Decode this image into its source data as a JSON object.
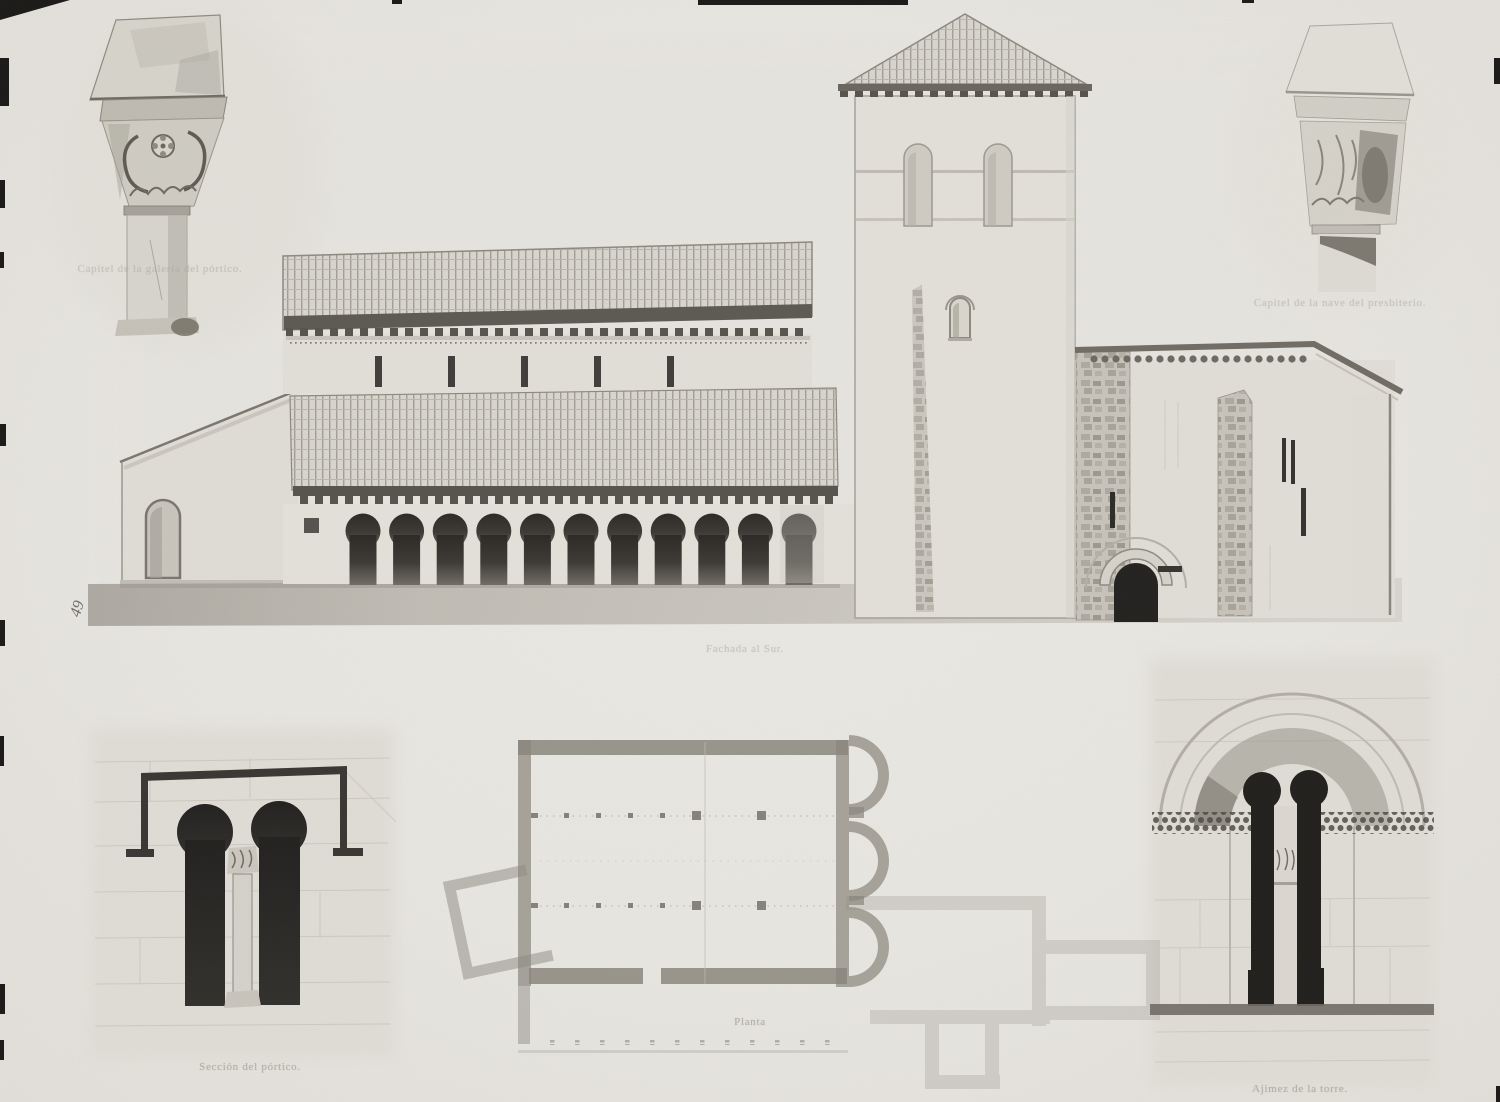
{
  "plate": {
    "margin_mark": "49",
    "panels": {
      "capital_left": {
        "caption": "Capitel de la galería del pórtico."
      },
      "capital_right": {
        "caption": "Capitel de la nave del presbiterio."
      },
      "elevation": {
        "caption": "Fachada al Sur."
      },
      "plan": {
        "caption": "Planta"
      },
      "window_section": {
        "caption": "Sección del pórtico."
      },
      "tower_window": {
        "caption": "Ajimez de la torre."
      }
    },
    "colors": {
      "paper": "#e9e7e2",
      "photo_tone": "#e2dfd8",
      "stone_light": "#d8d5ce",
      "stone_mid": "#aaa69d",
      "shadow_dark": "#2b2926",
      "caption_ink": "#a9a59c"
    }
  }
}
